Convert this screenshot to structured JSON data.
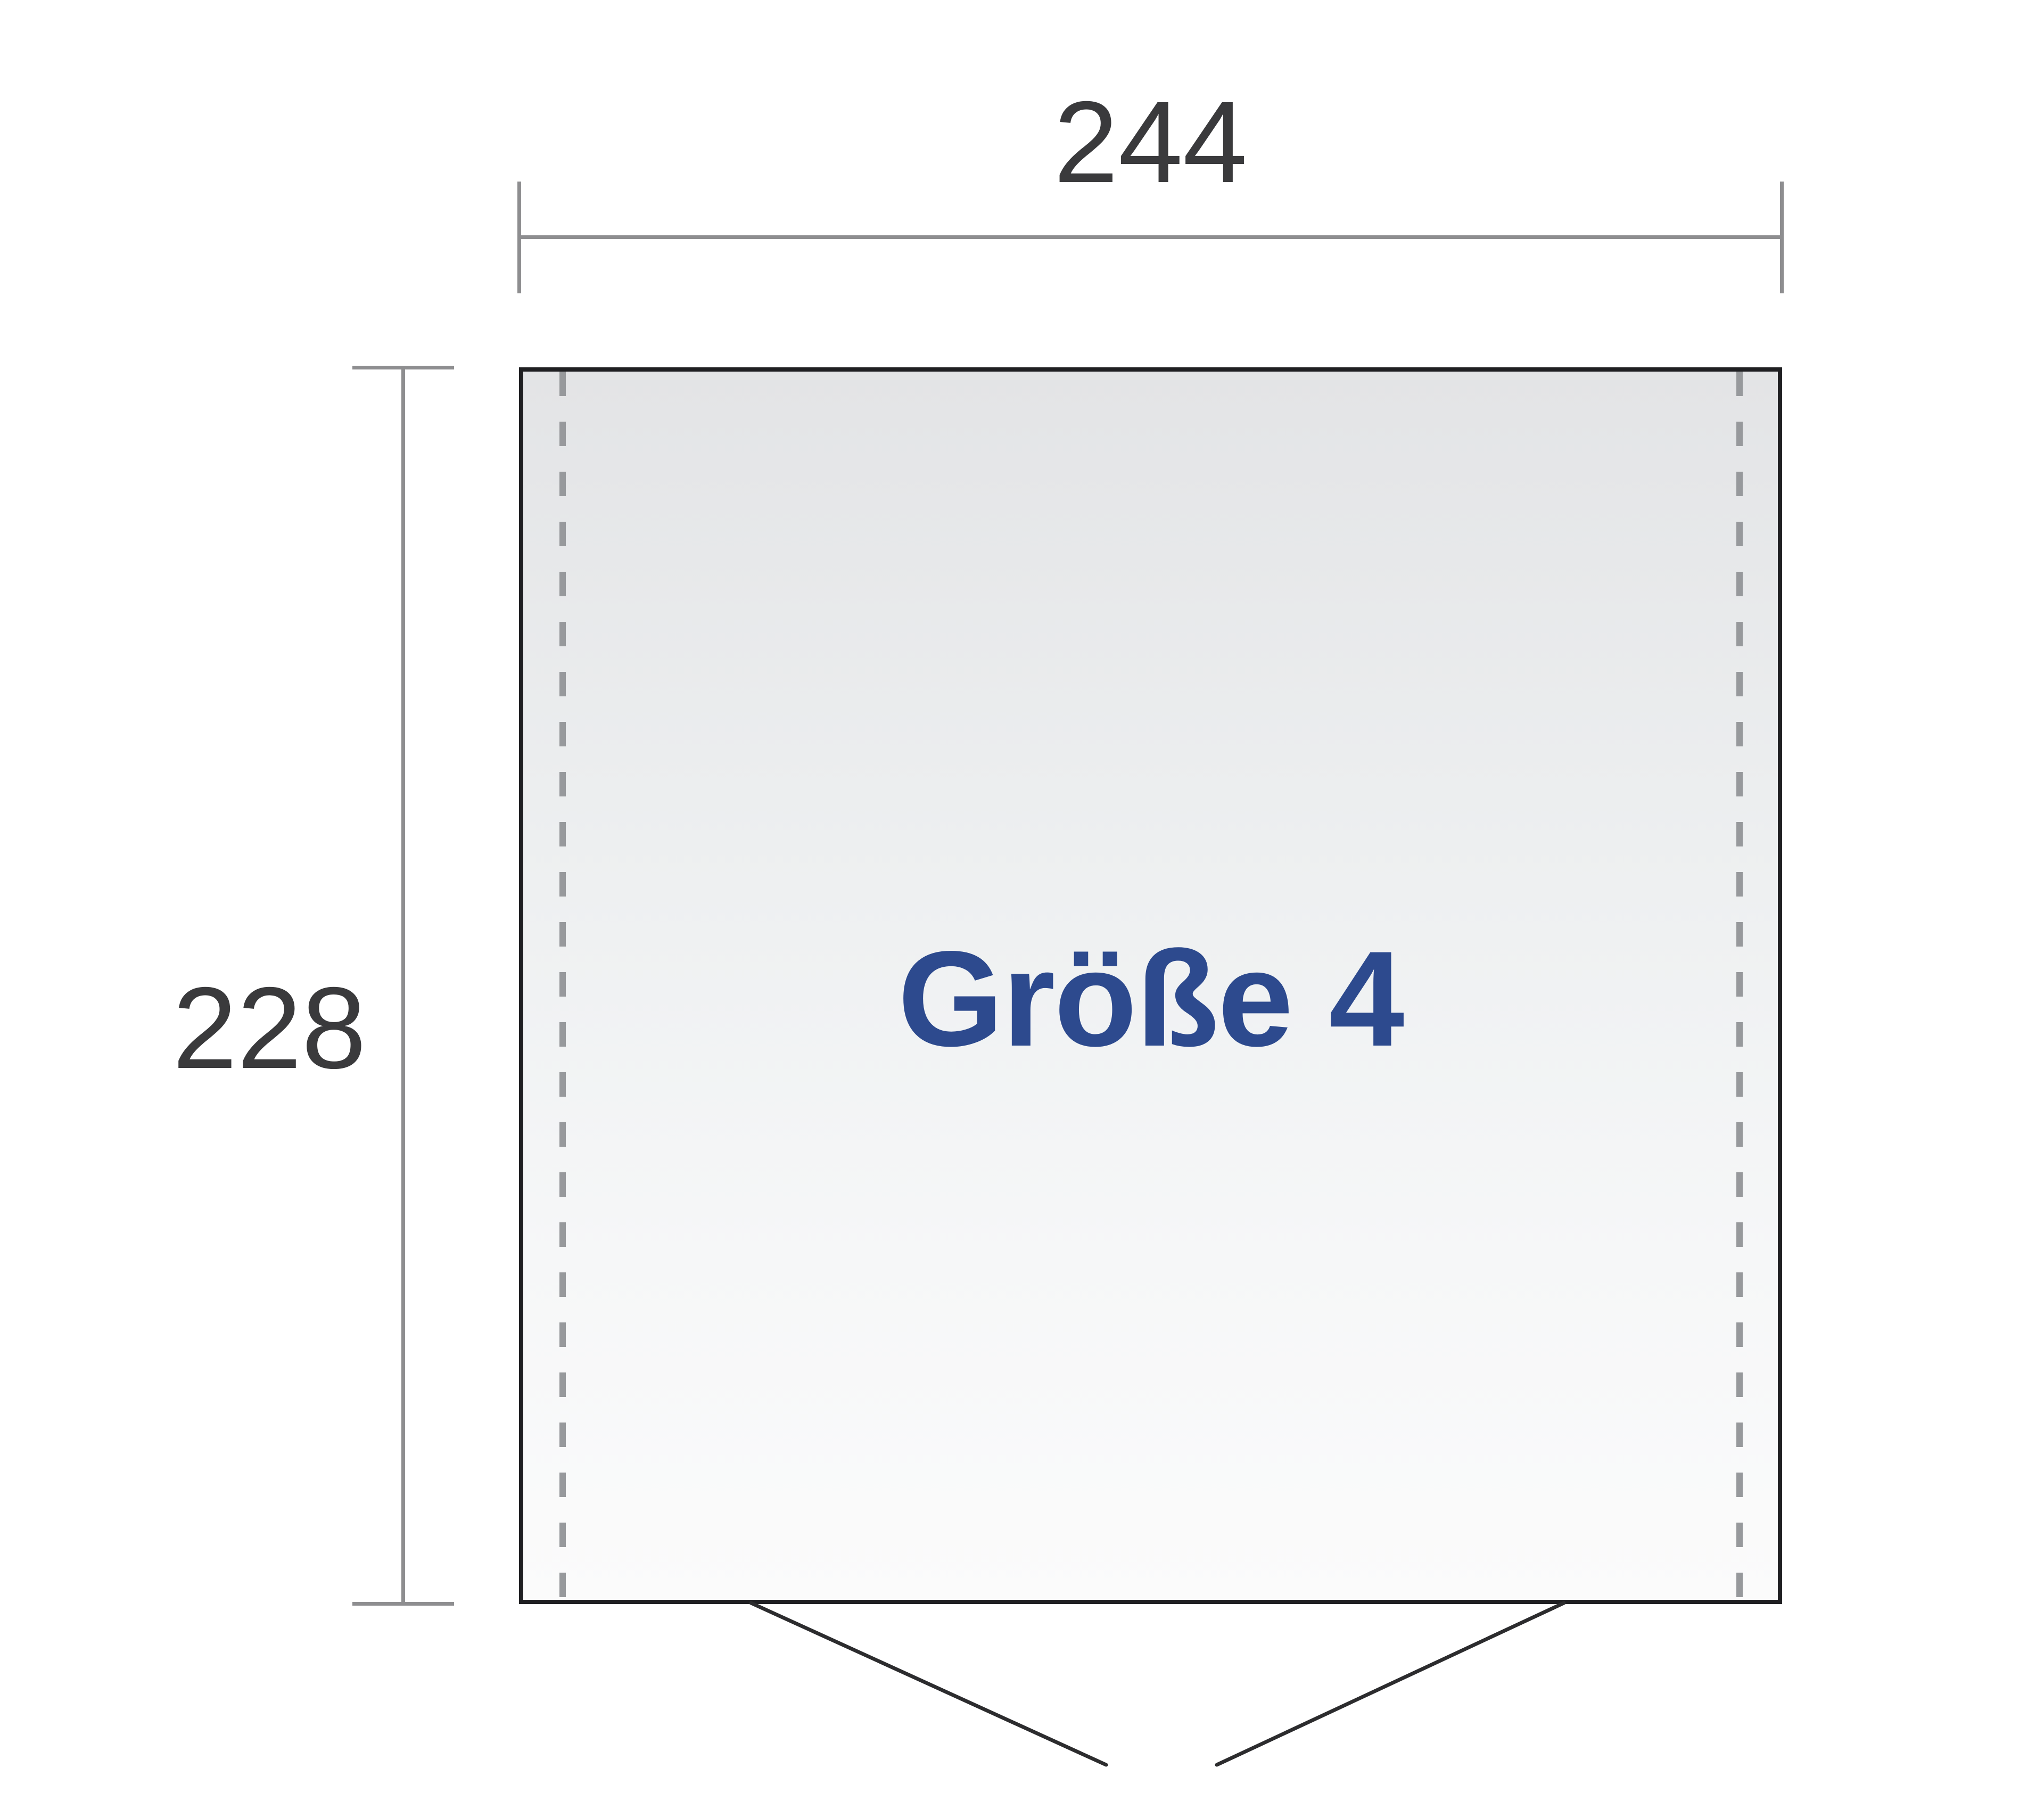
{
  "diagram": {
    "title": "Größe 4",
    "width_dimension": {
      "value": "244"
    },
    "height_dimension": {
      "value": "228"
    },
    "colors": {
      "size_label_text": "#2d4a8e",
      "dimension_text": "#3a3a3c",
      "dimension_lines": "#8e8e90",
      "outline": "#1f1f22",
      "dashed_lines": "#97999c",
      "door_lines": "#2c2c2e",
      "fill_top": "#e3e4e6",
      "fill_mid": "#eef0f1",
      "fill_bottom": "#fbfbfb",
      "page_bg": "#ffffff"
    }
  }
}
